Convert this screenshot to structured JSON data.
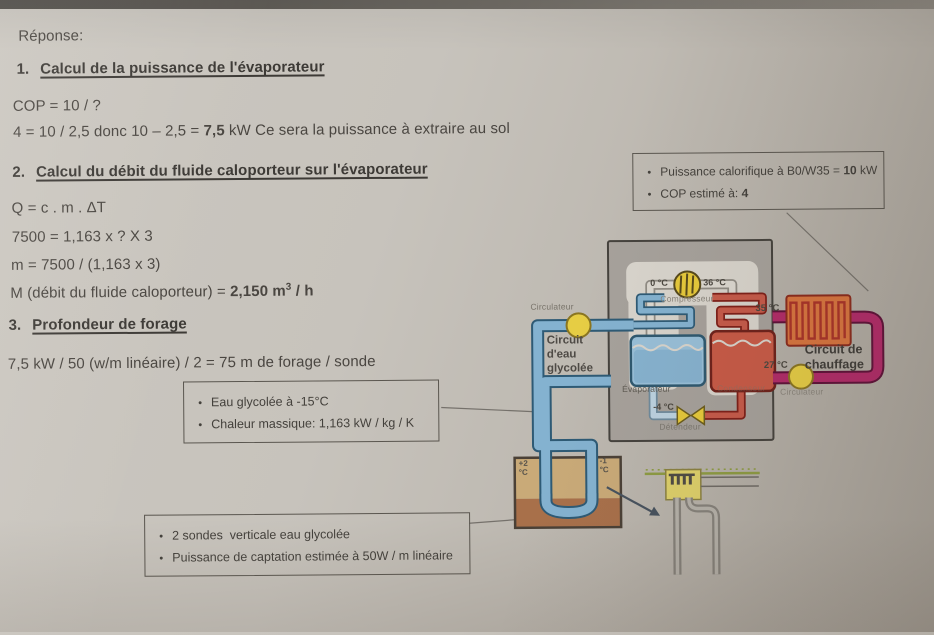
{
  "doc": {
    "reponse": "Réponse:",
    "s1_num": "1.",
    "s1_title": "Calcul de la puissance de l'évaporateur",
    "s1_l1": "COP = 10 / ?",
    "s1_l2a": "4 = 10 / 2,5 donc 10 – 2,5 = ",
    "s1_l2b": "7,5",
    "s1_l2c": " kW Ce sera la puissance à extraire au sol",
    "s2_num": "2.",
    "s2_title": "Calcul du débit du fluide caloporteur sur l'évaporateur",
    "s2_l1": "Q = c . m . ΔT",
    "s2_l2": "7500 = 1,163 x ? X 3",
    "s2_l3": "m = 7500 / (1,163 x 3)",
    "s2_l4a": "M (débit du fluide caloporteur) = ",
    "s2_l4b": "2,150 m",
    "s2_l4sup": "3",
    "s2_l4c": " / h",
    "s3_num": "3.",
    "s3_title": "Profondeur de forage",
    "s3_l1": "7,5 kW / 50 (w/m linéaire) / 2 = 75 m de forage / sonde"
  },
  "boxes": {
    "glycol": {
      "b1": "Eau glycolée à -15°C",
      "b2": "Chaleur massique: 1,163 kW / kg / K"
    },
    "sondes": {
      "b1": "2 sondes  verticale eau glycolée",
      "b2": "Puissance de captation estimée à 50W / m linéaire"
    },
    "power": {
      "b1a": "Puissance calorifique à B0/W35 = ",
      "b1b": "10",
      "b1c": " kW",
      "b2a": "COP estimé à: ",
      "b2b": "4"
    }
  },
  "diagram": {
    "labels": {
      "circulateur_left": "Circulateur",
      "circulateur_right": "Circulateur",
      "compresseur": "Compresseur",
      "evaporateur": "Évaporateur",
      "condenseur": "Condenseur",
      "detendeur": "Détendeur",
      "glycol_1": "Circuit",
      "glycol_2": "d'eau",
      "glycol_3": "glycolée",
      "chauffage_1": "Circuit de",
      "chauffage_2": "chauffage"
    },
    "temps": {
      "compressor_in": "0 °C",
      "compressor_out": "36 °C",
      "supply": "35 °C",
      "return": "27 °C",
      "expansion": "-4 °C",
      "ground_left_a": "+2",
      "ground_left_b": "°C",
      "ground_right_a": "-1",
      "ground_right_b": "°C"
    },
    "colors": {
      "glycol_pipe": "#84b2d0",
      "glycol_pipe_dark": "#2e5a75",
      "heating_pipe": "#b12a68",
      "heating_pipe_dark": "#5e1038",
      "refrigerant_hot": "#c65a49",
      "pump_yellow": "#e6cd44",
      "unit_gray": "#a6a19b",
      "radiator_orange": "#d8743e",
      "ground_tan": "#c9aa78",
      "ground_brown": "#a8704a"
    }
  }
}
